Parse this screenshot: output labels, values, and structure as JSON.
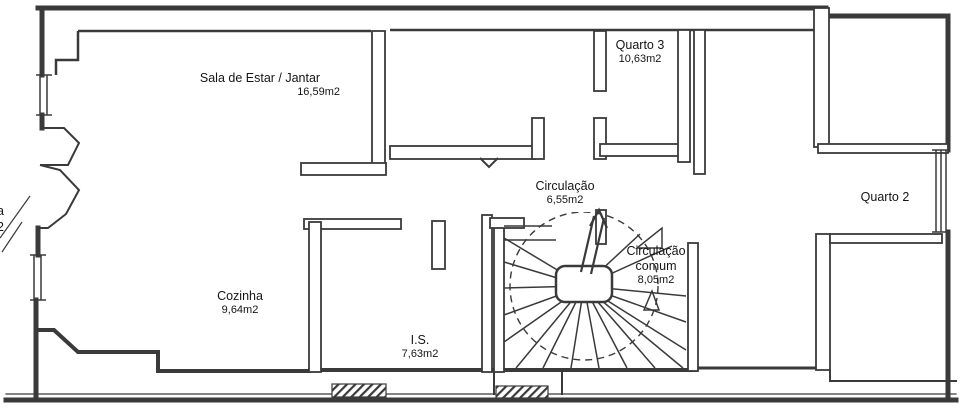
{
  "document": {
    "type": "floor-plan",
    "language": "pt"
  },
  "rooms": [
    {
      "name": "Sala de Estar / Jantar",
      "area": "16,59m2"
    },
    {
      "name": "Quarto 3",
      "area": "10,63m2"
    },
    {
      "name": "Circulação",
      "area": "6,55m2"
    },
    {
      "name": "Circulação comum",
      "area": "8,05m2"
    },
    {
      "name": "Quarto 2",
      "area": ""
    },
    {
      "name": "Cozinha",
      "area": "9,64m2"
    },
    {
      "name": "I.S.",
      "area": "7,63m2"
    }
  ],
  "edge_label": {
    "line1": "a",
    "line2": "2"
  },
  "symbols": [
    "winder-staircase",
    "stair-direction-arrow",
    "door-swing-triangle",
    "window-double-line",
    "hatched-window-sill"
  ],
  "colors": {
    "wall": "#3a3a3a",
    "background": "#ffffff",
    "text": "#151515"
  }
}
